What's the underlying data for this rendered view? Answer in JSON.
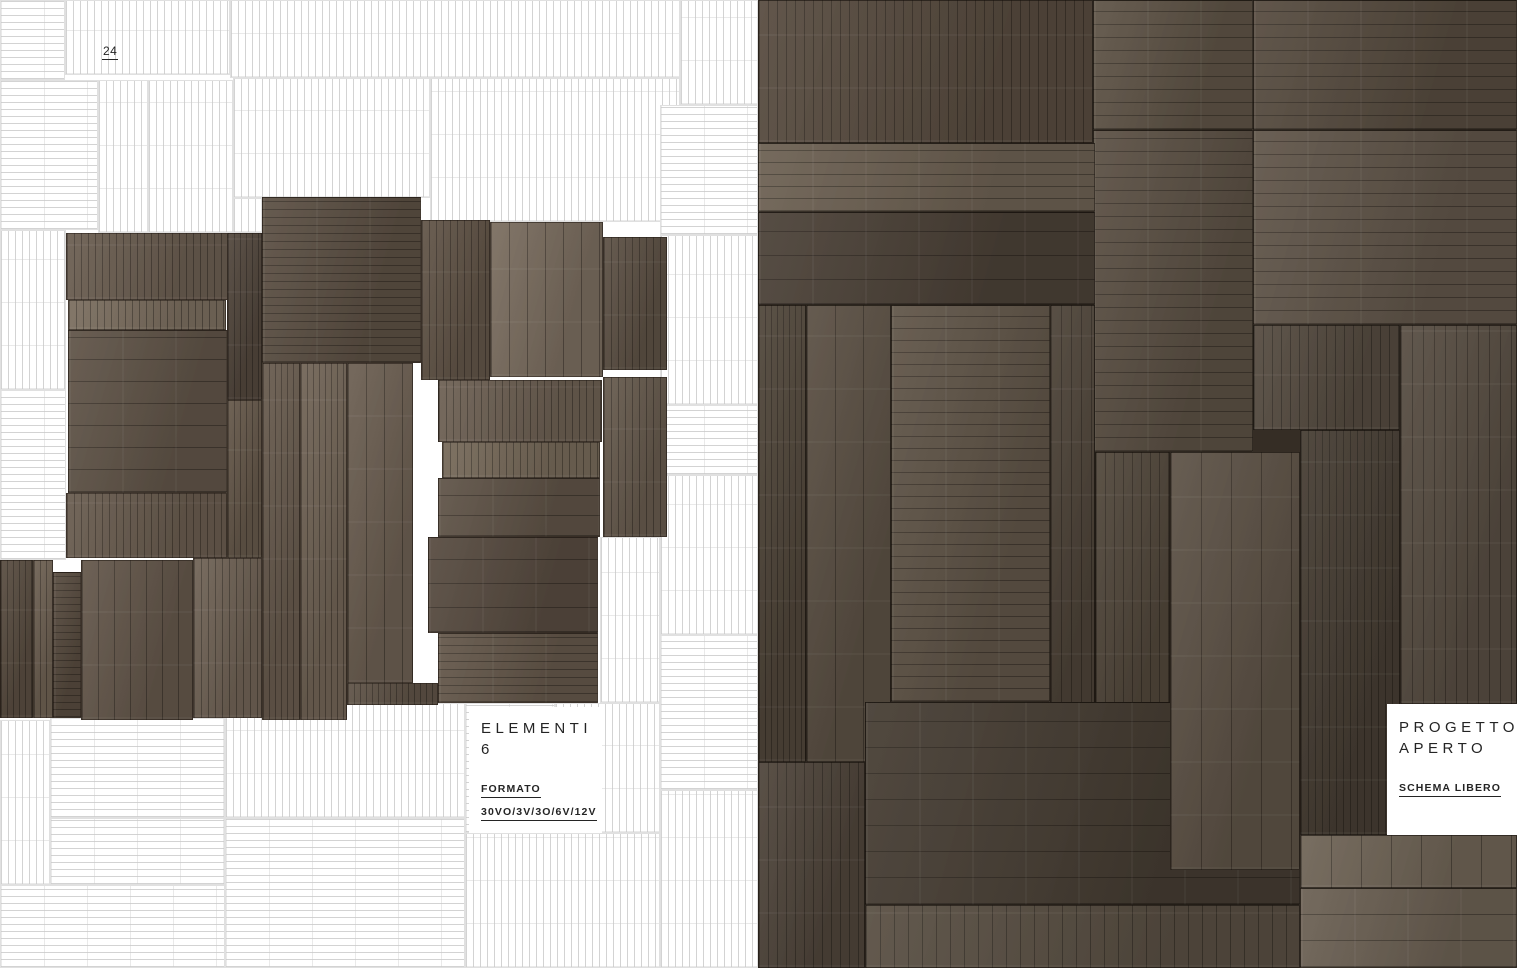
{
  "page": {
    "number": "24"
  },
  "left_page": {
    "label_box": {
      "title_line1": "ELEMENTI",
      "title_line2": "6",
      "format_label": "FORMATO",
      "format_value": "30VO/3V/3O/6V/12V"
    },
    "pattern_panels": [
      [
        0,
        0,
        65,
        80,
        "h"
      ],
      [
        65,
        0,
        165,
        75,
        "v"
      ],
      [
        230,
        0,
        450,
        78,
        "v"
      ],
      [
        680,
        0,
        78,
        105,
        "v"
      ],
      [
        0,
        80,
        98,
        150,
        "h"
      ],
      [
        98,
        80,
        50,
        153,
        "v"
      ],
      [
        148,
        80,
        85,
        153,
        "v"
      ],
      [
        233,
        78,
        197,
        120,
        "v"
      ],
      [
        430,
        78,
        250,
        144,
        "v"
      ],
      [
        0,
        230,
        66,
        160,
        "v"
      ],
      [
        0,
        390,
        66,
        170,
        "h"
      ],
      [
        233,
        198,
        29,
        35,
        "v"
      ],
      [
        660,
        105,
        98,
        130,
        "h"
      ],
      [
        660,
        235,
        98,
        170,
        "v"
      ],
      [
        660,
        405,
        98,
        70,
        "h"
      ],
      [
        660,
        475,
        98,
        160,
        "v"
      ],
      [
        660,
        635,
        98,
        155,
        "h"
      ],
      [
        660,
        790,
        98,
        178,
        "v"
      ],
      [
        600,
        537,
        60,
        166,
        "v"
      ],
      [
        0,
        720,
        50,
        165,
        "v"
      ],
      [
        0,
        885,
        225,
        83,
        "h"
      ],
      [
        50,
        718,
        175,
        100,
        "h"
      ],
      [
        50,
        818,
        175,
        67,
        "h"
      ],
      [
        225,
        703,
        240,
        115,
        "v"
      ],
      [
        225,
        818,
        240,
        150,
        "h"
      ],
      [
        465,
        833,
        195,
        135,
        "v"
      ],
      [
        465,
        703,
        90,
        130,
        "h"
      ],
      [
        555,
        703,
        105,
        130,
        "v"
      ]
    ],
    "cluster_tiles": [
      [
        66,
        233,
        162,
        67,
        "v",
        7,
        "#6a5d50"
      ],
      [
        68,
        300,
        158,
        30,
        "v",
        7,
        "#7a6d5e"
      ],
      [
        68,
        330,
        159,
        163,
        "h",
        22,
        "#5f5347"
      ],
      [
        66,
        493,
        161,
        65,
        "v",
        7,
        "#685b4e"
      ],
      [
        0,
        560,
        33,
        158,
        "v",
        6,
        "#584c40"
      ],
      [
        33,
        560,
        20,
        158,
        "v",
        6,
        "#6d6052"
      ],
      [
        53,
        572,
        28,
        146,
        "h",
        7,
        "#564a3e"
      ],
      [
        81,
        560,
        112,
        160,
        "v",
        16,
        "#63564a"
      ],
      [
        193,
        558,
        69,
        160,
        "v",
        7,
        "#6f6255"
      ],
      [
        227,
        233,
        35,
        167,
        "v",
        6,
        "#51463c"
      ],
      [
        227,
        400,
        35,
        158,
        "v",
        6,
        "#645749"
      ],
      [
        262,
        197,
        159,
        166,
        "h",
        8,
        "#5b4f43"
      ],
      [
        262,
        363,
        38,
        357,
        "v",
        6,
        "#675a4d"
      ],
      [
        300,
        363,
        47,
        357,
        "v",
        6,
        "#706355"
      ],
      [
        347,
        363,
        66,
        320,
        "v",
        18,
        "#6b5e51"
      ],
      [
        421,
        220,
        69,
        160,
        "v",
        7,
        "#615447"
      ],
      [
        490,
        222,
        113,
        155,
        "v",
        18,
        "#796c5e"
      ],
      [
        603,
        237,
        64,
        133,
        "v",
        7,
        "#5c5044"
      ],
      [
        438,
        380,
        164,
        62,
        "v",
        7,
        "#6c5f52"
      ],
      [
        442,
        442,
        158,
        36,
        "v",
        7,
        "#756858"
      ],
      [
        438,
        478,
        162,
        59,
        "h",
        20,
        "#5e5246"
      ],
      [
        603,
        377,
        64,
        160,
        "v",
        7,
        "#665a4d"
      ],
      [
        428,
        537,
        170,
        96,
        "h",
        24,
        "#564a3f"
      ],
      [
        438,
        633,
        160,
        70,
        "h",
        8,
        "#635649"
      ],
      [
        347,
        683,
        91,
        22,
        "v",
        6,
        "#5e5246"
      ]
    ]
  },
  "right_page": {
    "label_box": {
      "title_line1": "PROGETTO",
      "title_line2": "APERTO",
      "subtitle": "SCHEMA LIBERO"
    },
    "photo_panels": [
      [
        0,
        0,
        335,
        143,
        "v",
        9,
        "#564a3e"
      ],
      [
        335,
        0,
        160,
        130,
        "h",
        13,
        "#5d5245"
      ],
      [
        495,
        0,
        264,
        130,
        "h",
        13,
        "#554a3e"
      ],
      [
        495,
        130,
        264,
        195,
        "h",
        13,
        "#5f5448"
      ],
      [
        335,
        130,
        160,
        322,
        "h",
        13,
        "#5a4f43"
      ],
      [
        495,
        325,
        147,
        105,
        "v",
        9,
        "#544a3f"
      ],
      [
        0,
        143,
        337,
        69,
        "h",
        12,
        "#6b5f51"
      ],
      [
        0,
        212,
        337,
        93,
        "h",
        24,
        "#4a4036"
      ],
      [
        0,
        305,
        48,
        457,
        "v",
        6,
        "#4f4539"
      ],
      [
        48,
        305,
        85,
        457,
        "v",
        28,
        "#5a4f43"
      ],
      [
        133,
        305,
        159,
        397,
        "h",
        12,
        "#5f5447"
      ],
      [
        292,
        305,
        45,
        457,
        "v",
        10,
        "#4c4237"
      ],
      [
        337,
        452,
        75,
        310,
        "v",
        9,
        "#50463a"
      ],
      [
        107,
        702,
        435,
        203,
        "h",
        26,
        "#443b31"
      ],
      [
        412,
        452,
        130,
        418,
        "v",
        30,
        "#5c5145"
      ],
      [
        542,
        430,
        100,
        405,
        "v",
        7,
        "#453c32"
      ],
      [
        642,
        325,
        117,
        379,
        "v",
        11,
        "#564c41"
      ],
      [
        0,
        762,
        107,
        206,
        "v",
        9,
        "#4e443a"
      ],
      [
        107,
        905,
        435,
        63,
        "v",
        14,
        "#574d41"
      ],
      [
        542,
        835,
        217,
        53,
        "v",
        30,
        "#6e6355"
      ],
      [
        542,
        888,
        217,
        80,
        "h",
        26,
        "#6a5f52"
      ]
    ]
  },
  "colors": {
    "page_background": "#ffffff",
    "pattern_line": "#d3d3d3",
    "pattern_tick": "#c9c9c9",
    "photo_base": "#352d25",
    "seam": "#2c251f",
    "text": "#242424"
  }
}
